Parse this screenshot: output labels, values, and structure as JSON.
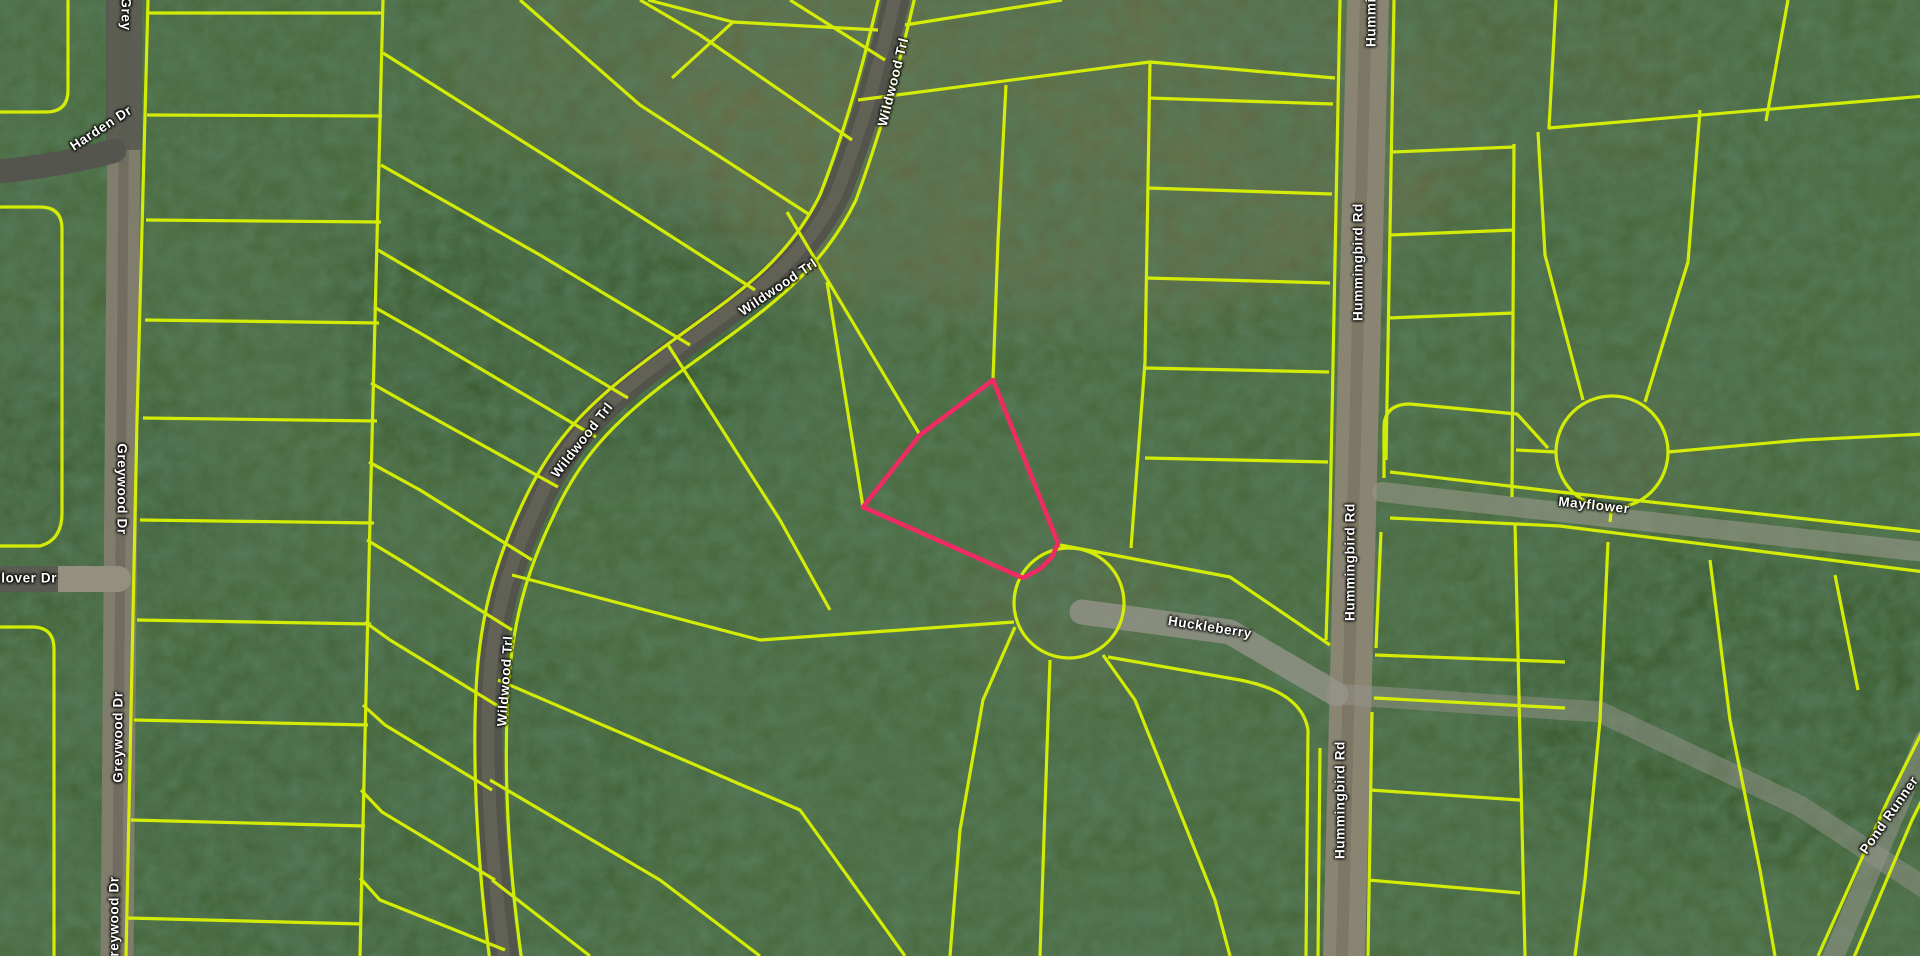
{
  "map": {
    "type": "satellite-parcel-view",
    "colors": {
      "parcel_line": "#d9f104",
      "highlight_outline": "#ee2b63",
      "terrain_base": "#3f5c35",
      "road_dark": "#53544c",
      "road_dirt": "#807d6d",
      "label_text": "#ffffff"
    },
    "highlighted_parcel": {
      "points": "993,380 920,435 863,507 1023,578 1040,569 1052,557 1058,543"
    },
    "road_labels": [
      {
        "id": "greywood-top-partial",
        "text": "Grey",
        "x": 126,
        "y": 14,
        "rot": 90
      },
      {
        "id": "harden-dr",
        "text": "Harden Dr",
        "x": 101,
        "y": 128,
        "rot": -33
      },
      {
        "id": "greywood-mid",
        "text": "Greywood Dr",
        "x": 122,
        "y": 489,
        "rot": 90
      },
      {
        "id": "greywood-lower",
        "text": "Greywood Dr",
        "x": 118,
        "y": 737,
        "rot": -90
      },
      {
        "id": "greywood-bottom",
        "text": "Greywood Dr",
        "x": 114,
        "y": 922,
        "rot": -90
      },
      {
        "id": "clover-dr",
        "text": "Clover Dr",
        "x": 24,
        "y": 578,
        "rot": 0
      },
      {
        "id": "wildwood-top",
        "text": "Wildwood Trl",
        "x": 893,
        "y": 82,
        "rot": -76
      },
      {
        "id": "wildwood-mid",
        "text": "Wildwood Trl",
        "x": 778,
        "y": 287,
        "rot": -34
      },
      {
        "id": "wildwood-third",
        "text": "Wildwood Trl",
        "x": 582,
        "y": 440,
        "rot": -52
      },
      {
        "id": "wildwood-bottom",
        "text": "Wildwood Trl",
        "x": 505,
        "y": 681,
        "rot": -86
      },
      {
        "id": "hummingbird-top",
        "text": "Hummingbird Rd",
        "x": 1371,
        "y": -12,
        "rot": -90
      },
      {
        "id": "hummingbird-upper",
        "text": "Hummingbird Rd",
        "x": 1358,
        "y": 262,
        "rot": -90
      },
      {
        "id": "hummingbird-mid",
        "text": "Hummingbird Rd",
        "x": 1350,
        "y": 562,
        "rot": -90
      },
      {
        "id": "hummingbird-lower",
        "text": "Hummingbird Rd",
        "x": 1340,
        "y": 800,
        "rot": -90
      },
      {
        "id": "huckleberry",
        "text": "Huckleberry",
        "x": 1210,
        "y": 627,
        "rot": 9
      },
      {
        "id": "mayflower",
        "text": "Mayflower",
        "x": 1594,
        "y": 505,
        "rot": 6
      },
      {
        "id": "pond-runner",
        "text": "Pond Runner",
        "x": 1889,
        "y": 815,
        "rot": -55
      }
    ]
  }
}
